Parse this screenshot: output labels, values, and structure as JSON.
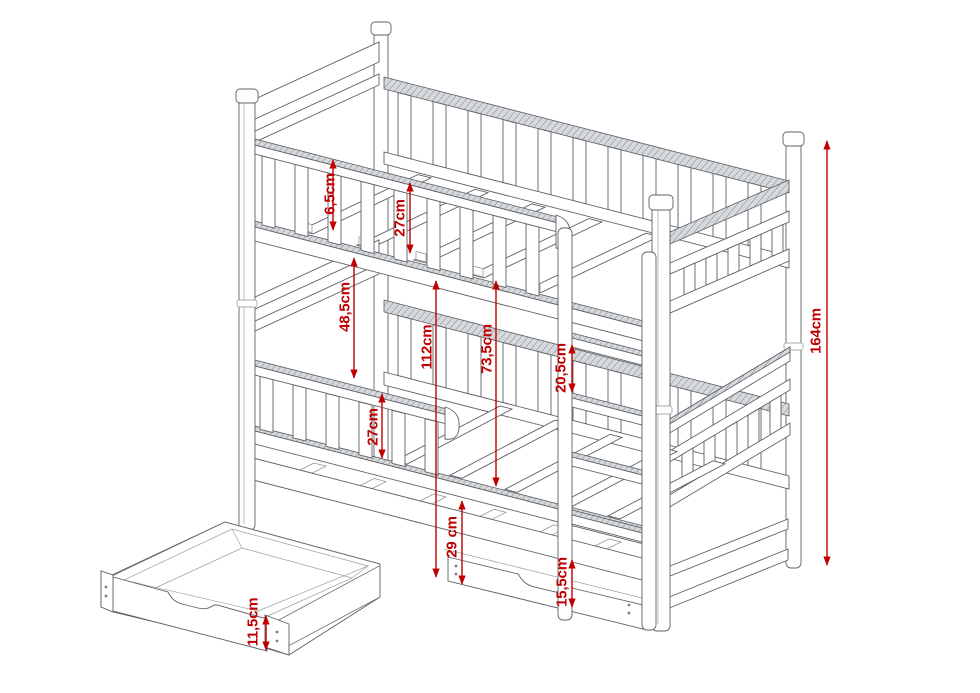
{
  "meta": {
    "type": "technical-drawing",
    "subject": "bunk bed with trundle, ladder and storage drawers",
    "units": "cm"
  },
  "colors": {
    "dimension_red": "#c00000",
    "line_gray": "#5d6064",
    "background": "#ffffff"
  },
  "dimensions": [
    {
      "name": "mattress-lip",
      "label": "6,5cm",
      "x": 333,
      "y1": 160,
      "y2": 230,
      "tx": 330,
      "ty": 194
    },
    {
      "name": "top-guard-height",
      "label": "27cm",
      "x": 410,
      "y1": 183,
      "y2": 253,
      "tx": 400,
      "ty": 218
    },
    {
      "name": "bunk-spacing",
      "label": "48,5cm",
      "x": 354,
      "y1": 258,
      "y2": 378,
      "tx": 345,
      "ty": 307
    },
    {
      "name": "top-bunk-height",
      "label": "112cm",
      "x": 436,
      "y1": 281,
      "y2": 577,
      "tx": 427,
      "ty": 347
    },
    {
      "name": "bunk-clearance",
      "label": "73,5cm",
      "x": 496,
      "y1": 281,
      "y2": 486,
      "tx": 487,
      "ty": 349
    },
    {
      "name": "rung-spacing",
      "label": "20,5cm",
      "x": 572,
      "y1": 345,
      "y2": 392,
      "tx": 561,
      "ty": 368
    },
    {
      "name": "total-height",
      "label": "164cm",
      "x": 827,
      "y1": 141,
      "y2": 565,
      "tx": 816,
      "ty": 331
    },
    {
      "name": "lower-guard-height",
      "label": "27cm",
      "x": 382,
      "y1": 394,
      "y2": 458,
      "tx": 373,
      "ty": 427
    },
    {
      "name": "under-bed-clearance",
      "label": "29 cm",
      "x": 462,
      "y1": 501,
      "y2": 584,
      "tx": 452,
      "ty": 537
    },
    {
      "name": "drawer-closed-height",
      "label": "15,5cm",
      "x": 572,
      "y1": 560,
      "y2": 607,
      "tx": 562,
      "ty": 582
    },
    {
      "name": "drawer-open-front-height",
      "label": "11,5cm",
      "x": 266,
      "y1": 616,
      "y2": 650,
      "tx": 253,
      "ty": 622
    }
  ]
}
